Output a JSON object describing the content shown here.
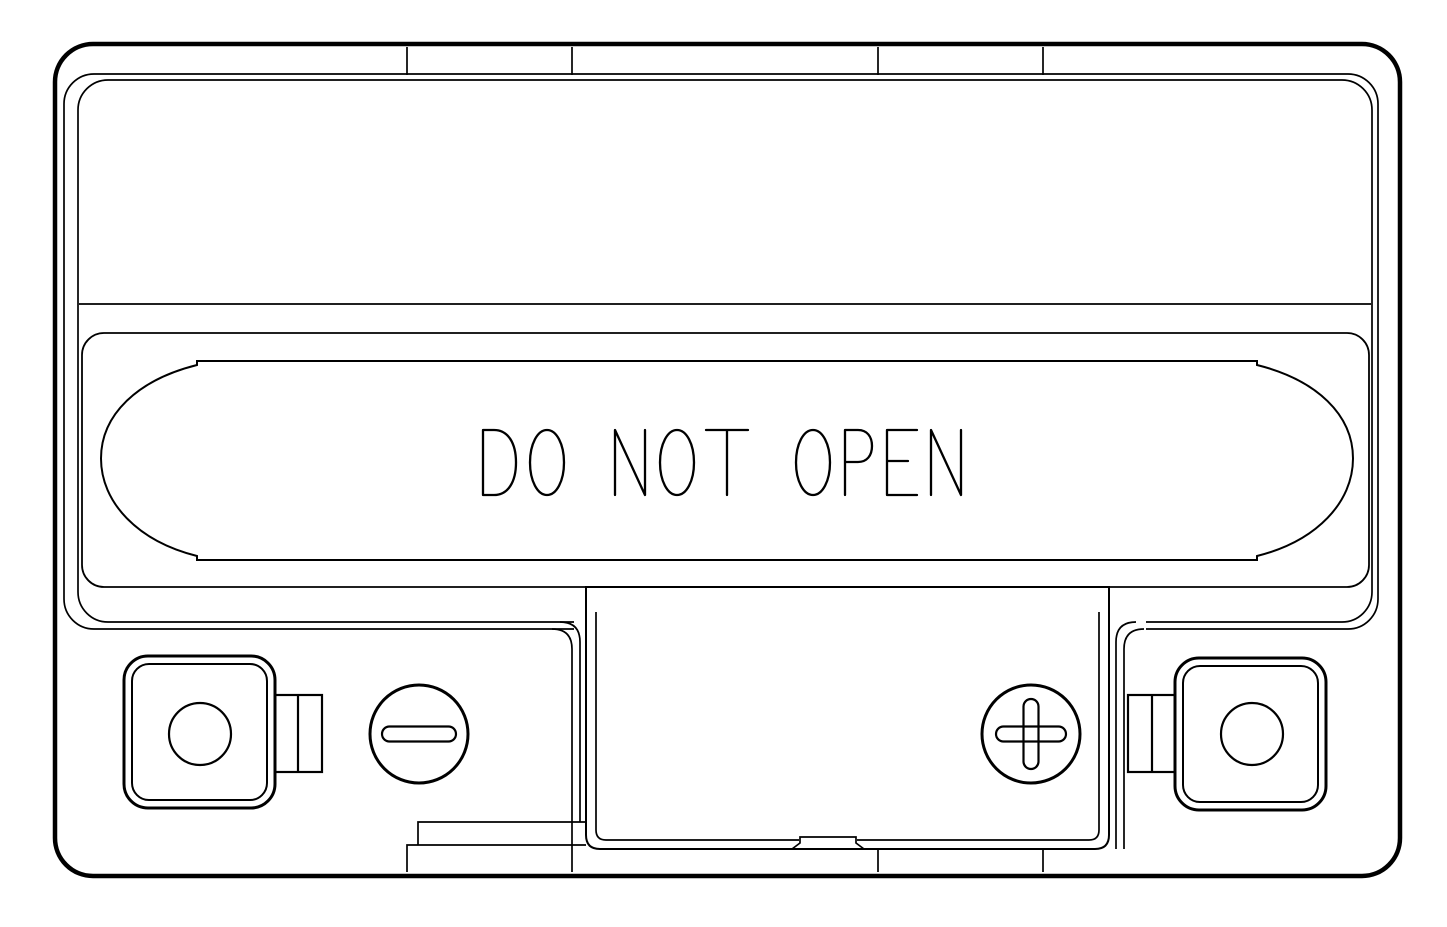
{
  "drawing": {
    "background_color": "#ffffff",
    "line_color": "#000000",
    "subject": "battery top view line drawing",
    "label": {
      "text": "DO NOT OPEN"
    },
    "terminals": {
      "negative": {
        "icon": "minus-icon",
        "symbol": "−",
        "side": "left"
      },
      "positive": {
        "icon": "plus-icon",
        "symbol": "+",
        "side": "right"
      }
    }
  }
}
